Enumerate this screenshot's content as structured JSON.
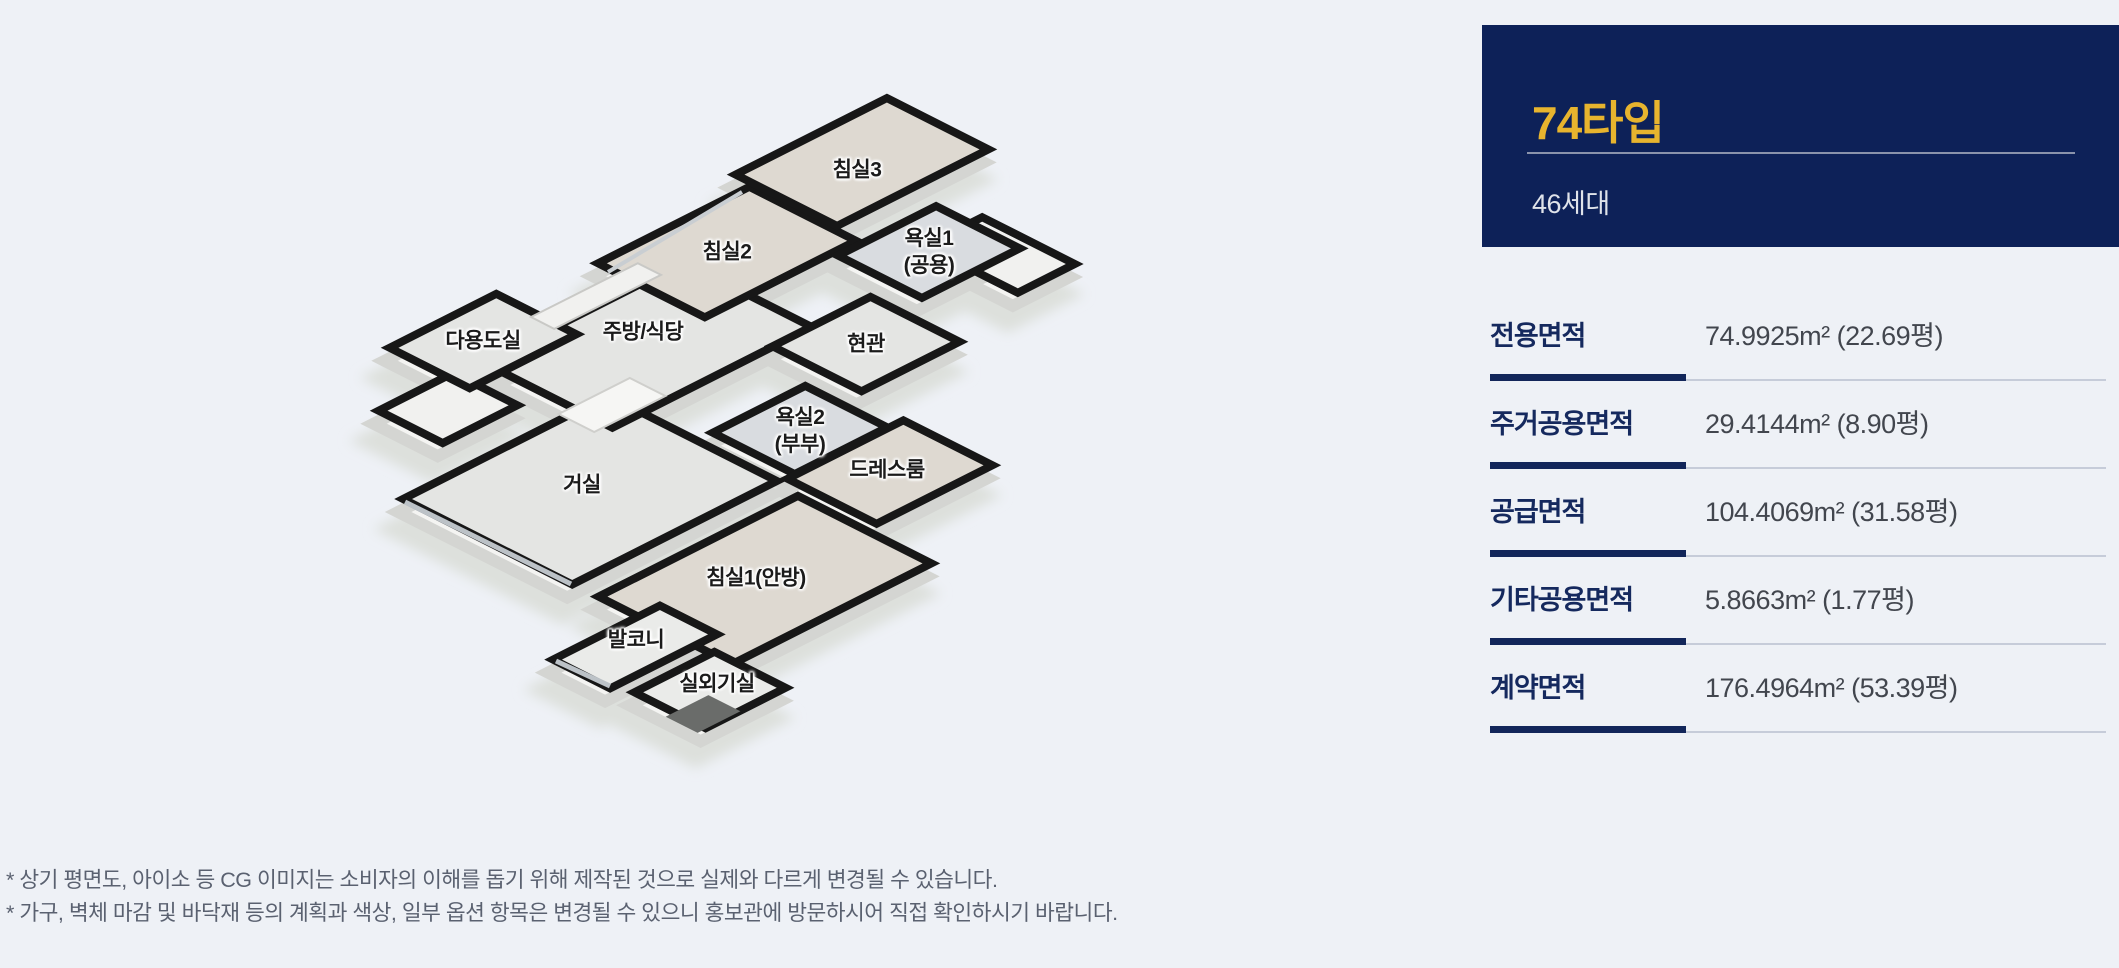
{
  "summary_card": {
    "type_title": "74타입",
    "unit_count": "46세대"
  },
  "area_table": {
    "rows": [
      {
        "label": "전용면적",
        "value": "74.9925m² (22.69평)"
      },
      {
        "label": "주거공용면적",
        "value": "29.4144m² (8.90평)"
      },
      {
        "label": "공급면적",
        "value": "104.4069m² (31.58평)"
      },
      {
        "label": "기타공용면적",
        "value": "5.8663m² (1.77평)"
      },
      {
        "label": "계약면적",
        "value": "176.4964m² (53.39평)"
      }
    ]
  },
  "notes": {
    "line1": "* 상기 평면도, 아이소 등 CG 이미지는 소비자의 이해를 돕기 위해 제작된 것으로 실제와 다르게 변경될 수 있습니다.",
    "line2": "* 가구, 벽체 마감 및 바닥재 등의 계획과 색상, 일부 옵션 항목은 변경될 수 있으니 홍보관에 방문하시어 직접 확인하시기 바랍니다."
  },
  "floor_plan": {
    "rooms": [
      {
        "id": "ext-ne",
        "label": null,
        "c": [
          1000,
          255
        ],
        "p": 32,
        "q": 52,
        "floor": "ext"
      },
      {
        "id": "ext-w",
        "label": null,
        "c": [
          448,
          408
        ],
        "p": 42,
        "q": 36,
        "floor": "ext"
      },
      {
        "id": "living",
        "label": "거실",
        "c": [
          590,
          490
        ],
        "p": 115,
        "q": 95,
        "floor": "tile",
        "label_pos": [
          582,
          485
        ]
      },
      {
        "id": "kitchen",
        "label": "주방/식당",
        "c": [
          648,
          345
        ],
        "p": 112,
        "q": 72,
        "floor": "tile",
        "label_pos": [
          643,
          332
        ]
      },
      {
        "id": "bedroom1",
        "label": "침실1(안방)",
        "c": [
          765,
          580
        ],
        "p": 112,
        "q": 75,
        "floor": "wood",
        "label_pos": [
          756,
          578
        ]
      },
      {
        "id": "bedroom2",
        "label": "침실2",
        "c": [
          727,
          252
        ],
        "p": 85,
        "q": 60,
        "floor": "wood",
        "label_pos": [
          727,
          252
        ]
      },
      {
        "id": "bedroom3",
        "label": "침실3",
        "c": [
          862,
          162
        ],
        "p": 85,
        "q": 57,
        "floor": "wood",
        "label_pos": [
          857,
          170
        ]
      },
      {
        "id": "bath1",
        "label": "욕실1\n(공용)",
        "c": [
          929,
          252
        ],
        "p": 55,
        "q": 47,
        "floor": "bath",
        "label_pos": [
          929,
          252
        ]
      },
      {
        "id": "entry",
        "label": "현관",
        "c": [
          866,
          344
        ],
        "p": 55,
        "q": 50,
        "floor": "tile",
        "label_pos": [
          866,
          344
        ]
      },
      {
        "id": "bath2",
        "label": "욕실2\n(부부)",
        "c": [
          800,
          430
        ],
        "p": 52,
        "q": 46,
        "floor": "bath",
        "label_pos": [
          800,
          431
        ]
      },
      {
        "id": "dress",
        "label": "드레스룸",
        "c": [
          890,
          472
        ],
        "p": 65,
        "q": 50,
        "floor": "wood",
        "label_pos": [
          887,
          470
        ]
      },
      {
        "id": "utility",
        "label": "다용도실",
        "c": [
          483,
          341
        ],
        "p": 60,
        "q": 45,
        "floor": "tile",
        "label_pos": [
          483,
          341
        ]
      },
      {
        "id": "balcony",
        "label": "발코니",
        "c": [
          635,
          647
        ],
        "p": 60,
        "q": 32,
        "floor": "light",
        "label_pos": [
          636,
          640
        ]
      },
      {
        "id": "ac-room",
        "label": "실외기실",
        "c": [
          710,
          690
        ],
        "p": 45,
        "q": 40,
        "floor": "light",
        "label_pos": [
          717,
          684
        ]
      }
    ]
  },
  "colors": {
    "page_bg": "#eef1f6",
    "card_bg": "#0d2158",
    "accent_gold": "#e7b42e",
    "table_label_navy": "#15295e",
    "rule_navy": "#12265a",
    "rule_gray": "#c6ccd9",
    "wall_black": "#171717",
    "floors": {
      "tile": "#e4e5e3",
      "wood": "#ded9d1",
      "bath": "#d9dce0",
      "light": "#eaebe9",
      "ext": "#f1f1ef"
    }
  }
}
